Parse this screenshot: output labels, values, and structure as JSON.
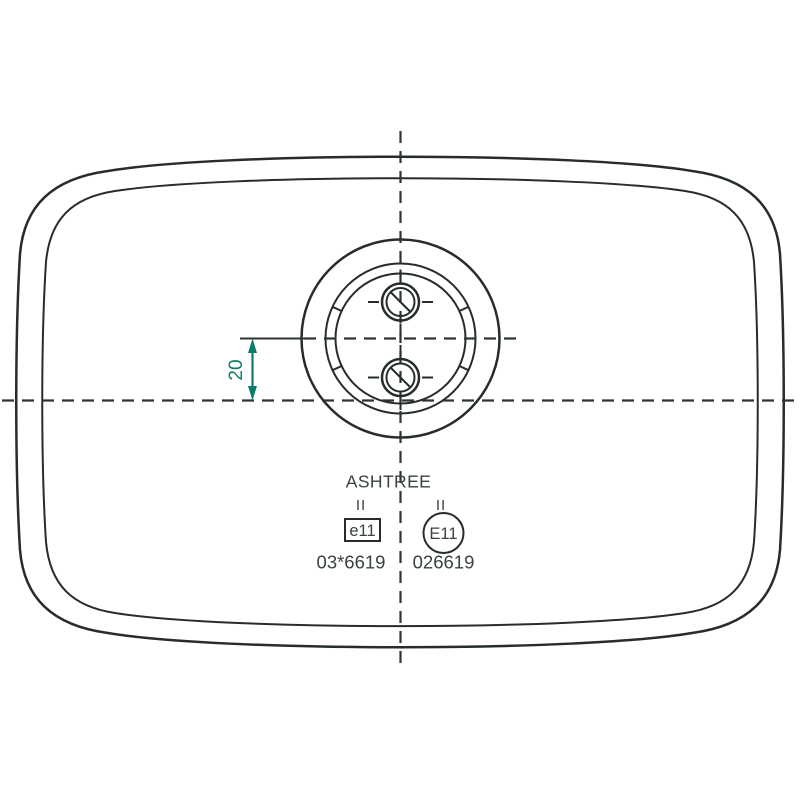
{
  "drawing": {
    "title": "rear-view technical drawing of lamp housing with mounting boss and approval marks",
    "dimension": {
      "value": "20"
    },
    "markings": {
      "brand": "ASHTREE",
      "left_class": "II",
      "right_class": "II",
      "e_mark_label": "e11",
      "e_mark_number": "03*6619",
      "E_mark_label": "E11",
      "E_mark_number": "026619"
    },
    "colors": {
      "rim_fill": "#cbd7d2",
      "inner_fill_light": "#91aca6",
      "inner_fill_dark": "#7e9a95",
      "mount_fill": "#c6d3cf",
      "line_dark": "#2a302f",
      "dimension_teal": "#0b7c6b",
      "text_dark": "#3a4141"
    }
  }
}
